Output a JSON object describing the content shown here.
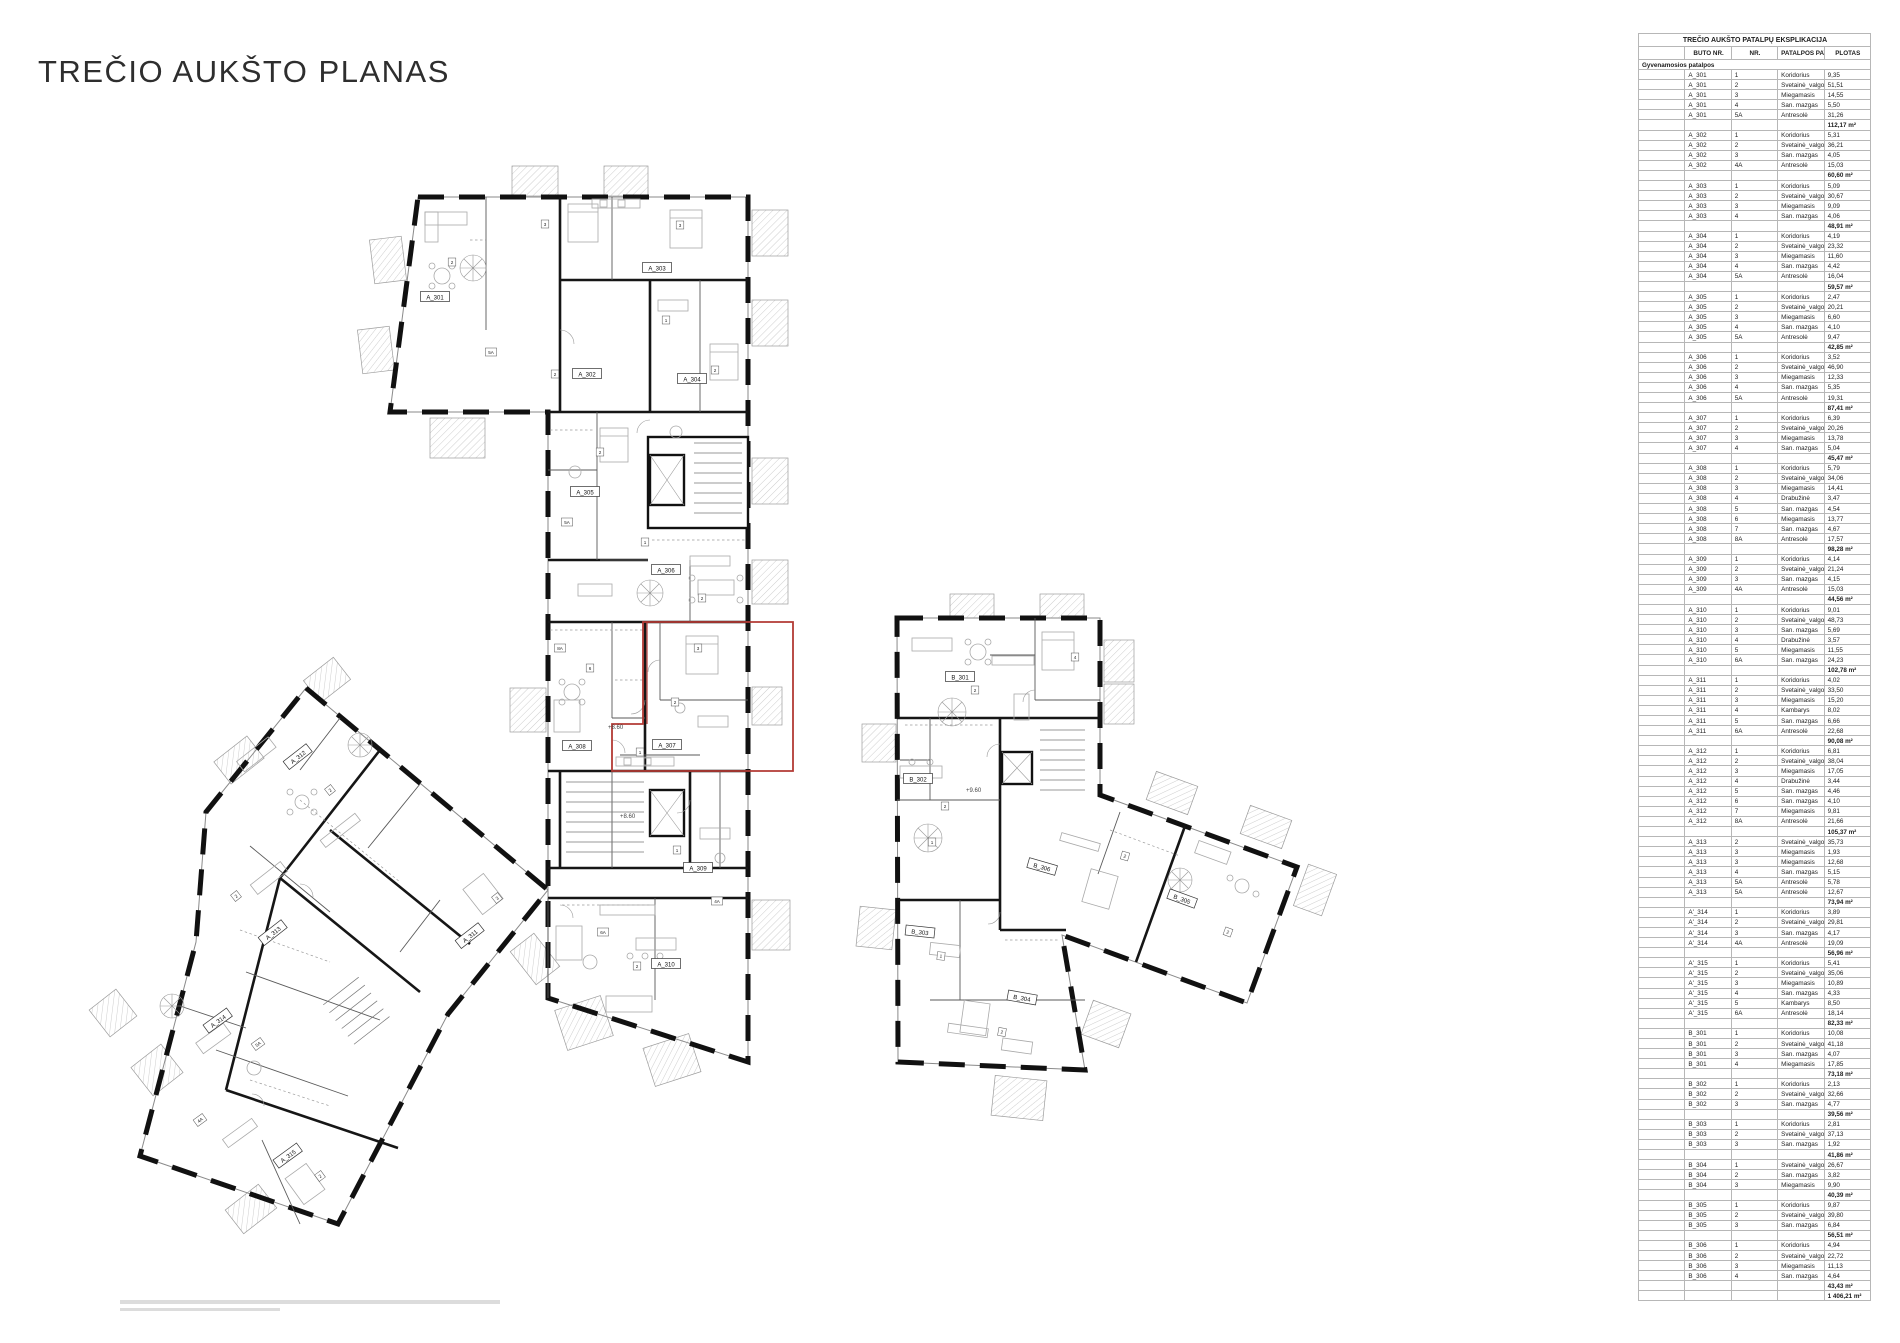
{
  "page": {
    "title": "TREČIO AUKŠTO PLANAS"
  },
  "table": {
    "title": "TREČIO AUKŠTO PATALPŲ EKSPLIKACIJA",
    "columns": [
      "",
      "BUTO NR.",
      "NR.",
      "PATALPOS PAVADINIMAS",
      "PLOTAS"
    ],
    "section": "Gyvenamosios patalpos",
    "apartments": [
      {
        "id": "A_301",
        "rooms": [
          [
            "1",
            "Koridorius",
            "9,35"
          ],
          [
            "2",
            "Svetainė_valgomasis_virtuvė",
            "51,51"
          ],
          [
            "3",
            "Miegamasis",
            "14,55"
          ],
          [
            "4",
            "San. mazgas",
            "5,50"
          ],
          [
            "5A",
            "Antresolė",
            "31,26"
          ]
        ],
        "total": "112,17 m²"
      },
      {
        "id": "A_302",
        "rooms": [
          [
            "1",
            "Koridorius",
            "5,31"
          ],
          [
            "2",
            "Svetainė_valgomasis_virtuvė",
            "36,21"
          ],
          [
            "3",
            "San. mazgas",
            "4,05"
          ],
          [
            "4A",
            "Antresolė",
            "15,03"
          ]
        ],
        "total": "60,60 m²"
      },
      {
        "id": "A_303",
        "rooms": [
          [
            "1",
            "Koridorius",
            "5,09"
          ],
          [
            "2",
            "Svetainė_valgomasis_virtuvė",
            "30,67"
          ],
          [
            "3",
            "Miegamasis",
            "9,09"
          ],
          [
            "4",
            "San. mazgas",
            "4,06"
          ]
        ],
        "total": "48,91 m²"
      },
      {
        "id": "A_304",
        "rooms": [
          [
            "1",
            "Koridorius",
            "4,19"
          ],
          [
            "2",
            "Svetainė_valgomasis_virtuvė",
            "23,32"
          ],
          [
            "3",
            "Miegamasis",
            "11,60"
          ],
          [
            "4",
            "San. mazgas",
            "4,42"
          ],
          [
            "5A",
            "Antresolė",
            "16,04"
          ]
        ],
        "total": "59,57 m²"
      },
      {
        "id": "A_305",
        "rooms": [
          [
            "1",
            "Koridorius",
            "2,47"
          ],
          [
            "2",
            "Svetainė_valgomasis_virtuvė",
            "20,21"
          ],
          [
            "3",
            "Miegamasis",
            "6,60"
          ],
          [
            "4",
            "San. mazgas",
            "4,10"
          ],
          [
            "5A",
            "Antresolė",
            "9,47"
          ]
        ],
        "total": "42,85 m²"
      },
      {
        "id": "A_306",
        "rooms": [
          [
            "1",
            "Koridorius",
            "3,52"
          ],
          [
            "2",
            "Svetainė_valgomasis_virtuvė",
            "46,90"
          ],
          [
            "3",
            "Miegamasis",
            "12,33"
          ],
          [
            "4",
            "San. mazgas",
            "5,35"
          ],
          [
            "5A",
            "Antresolė",
            "19,31"
          ]
        ],
        "total": "87,41 m²"
      },
      {
        "id": "A_307",
        "rooms": [
          [
            "1",
            "Koridorius",
            "6,39"
          ],
          [
            "2",
            "Svetainė_valgomasis_virtuvė",
            "20,26"
          ],
          [
            "3",
            "Miegamasis",
            "13,78"
          ],
          [
            "4",
            "San. mazgas",
            "5,04"
          ]
        ],
        "total": "45,47 m²"
      },
      {
        "id": "A_308",
        "rooms": [
          [
            "1",
            "Koridorius",
            "5,79"
          ],
          [
            "2",
            "Svetainė_valgomasis_virtuvė",
            "34,06"
          ],
          [
            "3",
            "Miegamasis",
            "14,41"
          ],
          [
            "4",
            "Drabužinė",
            "3,47"
          ],
          [
            "5",
            "San. mazgas",
            "4,54"
          ],
          [
            "6",
            "Miegamasis",
            "13,77"
          ],
          [
            "7",
            "San. mazgas",
            "4,67"
          ],
          [
            "8A",
            "Antresolė",
            "17,57"
          ]
        ],
        "total": "98,28 m²"
      },
      {
        "id": "A_309",
        "rooms": [
          [
            "1",
            "Koridorius",
            "4,14"
          ],
          [
            "2",
            "Svetainė_valgomasis_virtuvė",
            "21,24"
          ],
          [
            "3",
            "San. mazgas",
            "4,15"
          ],
          [
            "4A",
            "Antresolė",
            "15,03"
          ]
        ],
        "total": "44,56 m²"
      },
      {
        "id": "A_310",
        "rooms": [
          [
            "1",
            "Koridorius",
            "9,01"
          ],
          [
            "2",
            "Svetainė_valgomasis_virtuvė",
            "48,73"
          ],
          [
            "3",
            "San. mazgas",
            "5,69"
          ],
          [
            "4",
            "Drabužinė",
            "3,57"
          ],
          [
            "5",
            "Miegamasis",
            "11,55"
          ],
          [
            "6A",
            "San. mazgas",
            "24,23"
          ]
        ],
        "total": "102,78 m²"
      },
      {
        "id": "A_311",
        "rooms": [
          [
            "1",
            "Koridorius",
            "4,02"
          ],
          [
            "2",
            "Svetainė_valgomasis_virtuvė",
            "33,50"
          ],
          [
            "3",
            "Miegamasis",
            "15,20"
          ],
          [
            "4",
            "Kambarys",
            "8,02"
          ],
          [
            "5",
            "San. mazgas",
            "6,66"
          ],
          [
            "6A",
            "Antresolė",
            "22,68"
          ]
        ],
        "total": "90,08 m²"
      },
      {
        "id": "A_312",
        "rooms": [
          [
            "1",
            "Koridorius",
            "6,81"
          ],
          [
            "2",
            "Svetainė_valgomasis_virtuvė",
            "38,04"
          ],
          [
            "3",
            "Miegamasis",
            "17,05"
          ],
          [
            "4",
            "Drabužinė",
            "3,44"
          ],
          [
            "5",
            "San. mazgas",
            "4,46"
          ],
          [
            "6",
            "San. mazgas",
            "4,10"
          ],
          [
            "7",
            "Miegamasis",
            "9,81"
          ],
          [
            "8A",
            "Antresolė",
            "21,66"
          ]
        ],
        "total": "105,37 m²"
      },
      {
        "id": "A_313",
        "rooms": [
          [
            "2",
            "Svetainė_valgomasis_virtuvė",
            "35,73"
          ],
          [
            "3",
            "Miegamasis",
            "1,93"
          ],
          [
            "3",
            "Miegamasis",
            "12,68"
          ],
          [
            "4",
            "San. mazgas",
            "5,15"
          ],
          [
            "5A",
            "Antresolė",
            "5,78"
          ],
          [
            "5A",
            "Antresolė",
            "12,67"
          ]
        ],
        "total": "73,94 m²"
      },
      {
        "id": "A'_314",
        "rooms": [
          [
            "1",
            "Koridorius",
            "3,89"
          ],
          [
            "2",
            "Svetainė_valgomasis_virtuvė",
            "29,81"
          ],
          [
            "3",
            "San. mazgas",
            "4,17"
          ],
          [
            "4A",
            "Antresolė",
            "19,09"
          ]
        ],
        "total": "56,96 m²"
      },
      {
        "id": "A'_315",
        "rooms": [
          [
            "1",
            "Koridorius",
            "5,41"
          ],
          [
            "2",
            "Svetainė_valgomasis_virtuvė",
            "35,06"
          ],
          [
            "3",
            "Miegamasis",
            "10,89"
          ],
          [
            "4",
            "San. mazgas",
            "4,33"
          ],
          [
            "5",
            "Kambarys",
            "8,50"
          ],
          [
            "6A",
            "Antresolė",
            "18,14"
          ]
        ],
        "total": "82,33 m²"
      },
      {
        "id": "B_301",
        "rooms": [
          [
            "1",
            "Koridorius",
            "10,08"
          ],
          [
            "2",
            "Svetainė_valgomasis_virtuvė",
            "41,18"
          ],
          [
            "3",
            "San. mazgas",
            "4,07"
          ],
          [
            "4",
            "Miegamasis",
            "17,85"
          ]
        ],
        "total": "73,18 m²"
      },
      {
        "id": "B_302",
        "rooms": [
          [
            "1",
            "Koridorius",
            "2,13"
          ],
          [
            "2",
            "Svetainė_valgomasis_virtuvė",
            "32,66"
          ],
          [
            "3",
            "San. mazgas",
            "4,77"
          ]
        ],
        "total": "39,56 m²"
      },
      {
        "id": "B_303",
        "rooms": [
          [
            "1",
            "Koridorius",
            "2,81"
          ],
          [
            "2",
            "Svetainė_valgomasis_virtuvė",
            "37,13"
          ],
          [
            "3",
            "San. mazgas",
            "1,92"
          ]
        ],
        "total": "41,86 m²"
      },
      {
        "id": "B_304",
        "rooms": [
          [
            "1",
            "Svetainė_valgomasis_virtuvė",
            "26,67"
          ],
          [
            "2",
            "San. mazgas",
            "3,82"
          ],
          [
            "3",
            "Miegamasis",
            "9,90"
          ]
        ],
        "total": "40,39 m²"
      },
      {
        "id": "B_305",
        "rooms": [
          [
            "1",
            "Koridorius",
            "9,87"
          ],
          [
            "2",
            "Svetainė_valgomasis_virtuvė",
            "39,80"
          ],
          [
            "3",
            "San. mazgas",
            "6,84"
          ]
        ],
        "total": "56,51 m²"
      },
      {
        "id": "B_306",
        "rooms": [
          [
            "1",
            "Koridorius",
            "4,94"
          ],
          [
            "2",
            "Svetainė_valgomasis_virtuvė",
            "22,72"
          ],
          [
            "3",
            "Miegamasis",
            "11,13"
          ],
          [
            "4",
            "San. mazgas",
            "4,64"
          ]
        ],
        "total": "43,43 m²"
      }
    ],
    "grand_total": "1 406,21 m²"
  },
  "plan": {
    "highlight_color": "#b23a34",
    "apartment_labels": [
      {
        "text": "A_301",
        "x": 435,
        "y": 297,
        "r": 0
      },
      {
        "text": "A_302",
        "x": 587,
        "y": 374,
        "r": 0
      },
      {
        "text": "A_303",
        "x": 657,
        "y": 268,
        "r": 0
      },
      {
        "text": "A_304",
        "x": 692,
        "y": 379,
        "r": 0
      },
      {
        "text": "A_305",
        "x": 585,
        "y": 492,
        "r": 0
      },
      {
        "text": "A_306",
        "x": 666,
        "y": 570,
        "r": 0
      },
      {
        "text": "A_307",
        "x": 667,
        "y": 745,
        "r": 0
      },
      {
        "text": "A_308",
        "x": 577,
        "y": 746,
        "r": 0
      },
      {
        "text": "A_309",
        "x": 698,
        "y": 868,
        "r": 0
      },
      {
        "text": "A_310",
        "x": 666,
        "y": 964,
        "r": 0
      },
      {
        "text": "A_311",
        "x": 470,
        "y": 936,
        "r": -38
      },
      {
        "text": "A_312",
        "x": 298,
        "y": 757,
        "r": -38
      },
      {
        "text": "A_313",
        "x": 273,
        "y": 933,
        "r": -38
      },
      {
        "text": "A_314",
        "x": 218,
        "y": 1021,
        "r": -36
      },
      {
        "text": "A_315",
        "x": 288,
        "y": 1156,
        "r": -36
      },
      {
        "text": "B_301",
        "x": 960,
        "y": 677,
        "r": 0
      },
      {
        "text": "B_302",
        "x": 918,
        "y": 779,
        "r": 0
      },
      {
        "text": "B_303",
        "x": 920,
        "y": 932,
        "r": 6
      },
      {
        "text": "B_304",
        "x": 1022,
        "y": 998,
        "r": 10
      },
      {
        "text": "B_305",
        "x": 1182,
        "y": 899,
        "r": 20
      },
      {
        "text": "B_306",
        "x": 1042,
        "y": 867,
        "r": 16
      }
    ],
    "room_tags": [
      {
        "t": "2",
        "x": 452,
        "y": 262,
        "r": 0
      },
      {
        "t": "3",
        "x": 545,
        "y": 224,
        "r": 0
      },
      {
        "t": "5A",
        "x": 491,
        "y": 352,
        "r": 0
      },
      {
        "t": "3",
        "x": 680,
        "y": 225,
        "r": 0
      },
      {
        "t": "2",
        "x": 555,
        "y": 374,
        "r": 0
      },
      {
        "t": "2",
        "x": 715,
        "y": 370,
        "r": 0
      },
      {
        "t": "1",
        "x": 666,
        "y": 320,
        "r": 0
      },
      {
        "t": "5A",
        "x": 567,
        "y": 522,
        "r": 0
      },
      {
        "t": "2",
        "x": 600,
        "y": 452,
        "r": 0
      },
      {
        "t": "2",
        "x": 702,
        "y": 598,
        "r": 0
      },
      {
        "t": "1",
        "x": 645,
        "y": 542,
        "r": 0
      },
      {
        "t": "3",
        "x": 698,
        "y": 648,
        "r": 0
      },
      {
        "t": "2",
        "x": 675,
        "y": 702,
        "r": 0
      },
      {
        "t": "1",
        "x": 640,
        "y": 752,
        "r": 0
      },
      {
        "t": "6",
        "x": 590,
        "y": 668,
        "r": 0
      },
      {
        "t": "8A",
        "x": 560,
        "y": 648,
        "r": 0
      },
      {
        "t": "1",
        "x": 677,
        "y": 850,
        "r": 0
      },
      {
        "t": "4A",
        "x": 717,
        "y": 901,
        "r": 0
      },
      {
        "t": "2",
        "x": 637,
        "y": 966,
        "r": 0
      },
      {
        "t": "6A",
        "x": 603,
        "y": 932,
        "r": 0
      },
      {
        "t": "2",
        "x": 975,
        "y": 690,
        "r": 0
      },
      {
        "t": "4",
        "x": 1075,
        "y": 657,
        "r": 0
      },
      {
        "t": "2",
        "x": 945,
        "y": 806,
        "r": 0
      },
      {
        "t": "1",
        "x": 932,
        "y": 842,
        "r": 0
      },
      {
        "t": "2",
        "x": 1125,
        "y": 856,
        "r": 16
      },
      {
        "t": "2",
        "x": 1228,
        "y": 932,
        "r": 20
      },
      {
        "t": "1",
        "x": 941,
        "y": 956,
        "r": 6
      },
      {
        "t": "2",
        "x": 1002,
        "y": 1032,
        "r": 10
      },
      {
        "t": "2",
        "x": 330,
        "y": 790,
        "r": -38
      },
      {
        "t": "3",
        "x": 497,
        "y": 898,
        "r": -38
      },
      {
        "t": "2",
        "x": 236,
        "y": 896,
        "r": -38
      },
      {
        "t": "5A",
        "x": 258,
        "y": 1044,
        "r": -36
      },
      {
        "t": "2",
        "x": 320,
        "y": 1176,
        "r": -36
      },
      {
        "t": "4A",
        "x": 200,
        "y": 1120,
        "r": -36
      }
    ],
    "elevation_marks": [
      {
        "text": "+8.60",
        "x": 608,
        "y": 729
      },
      {
        "text": "+8.60",
        "x": 620,
        "y": 818
      },
      {
        "text": "+9.60",
        "x": 966,
        "y": 792
      }
    ]
  }
}
